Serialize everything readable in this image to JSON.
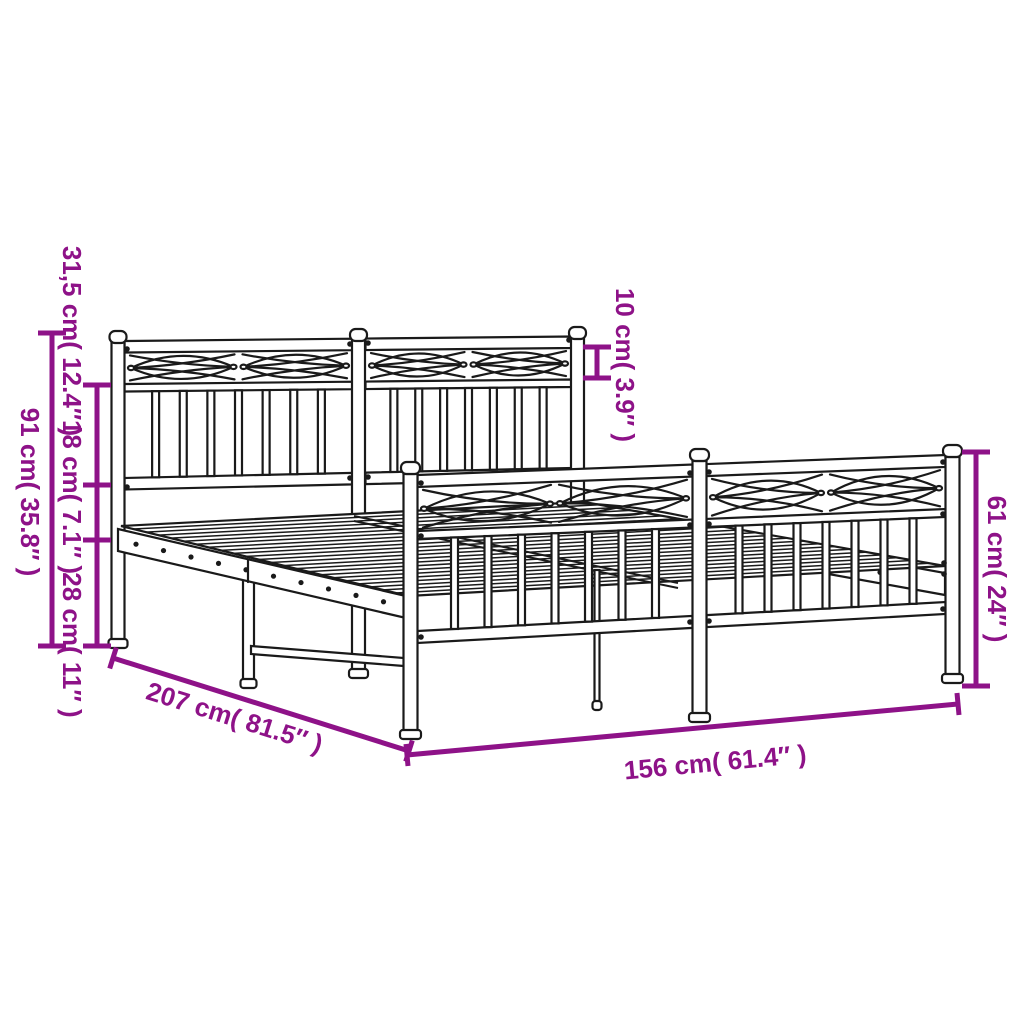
{
  "colors": {
    "accent": "#8E1288",
    "line": "#1a1a1a",
    "background": "#ffffff"
  },
  "dimensions": {
    "overall_height": "91 cm( 35.8″ )",
    "headboard_panel_height": "31,5 cm( 12.4″ )",
    "gap_height": "18 cm( 7.1″ )",
    "base_height": "28 cm( 11″ )",
    "top_band_height": "10 cm( 3.9″ )",
    "footboard_height": "61 cm( 24″ )",
    "length": "207 cm( 81.5″ )",
    "width": "156 cm( 61.4″ )"
  }
}
